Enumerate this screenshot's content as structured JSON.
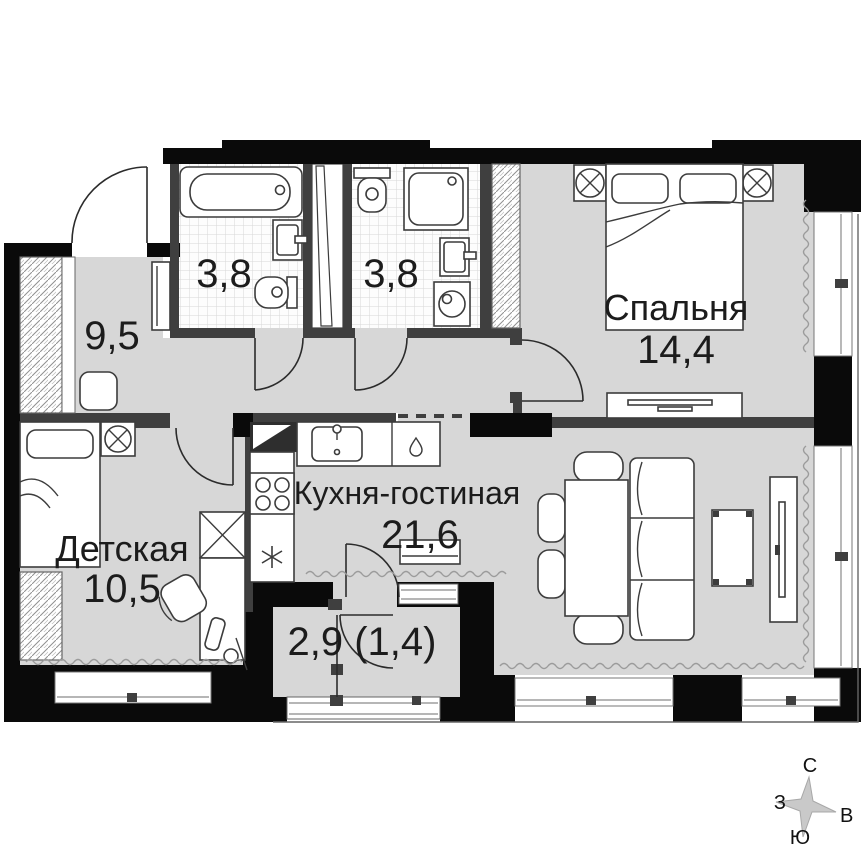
{
  "plan": {
    "title": "apartment-floor-plan",
    "rooms": [
      {
        "id": "hallway",
        "name": "",
        "area": "9,5"
      },
      {
        "id": "bathroom-1",
        "name": "",
        "area": "3,8"
      },
      {
        "id": "bathroom-2",
        "name": "",
        "area": "3,8"
      },
      {
        "id": "bedroom",
        "name": "Спальня",
        "area": "14,4"
      },
      {
        "id": "kitchen-living",
        "name": "Кухня-гостиная",
        "area": "21,6"
      },
      {
        "id": "children-room",
        "name": "Детская",
        "area": "10,5"
      },
      {
        "id": "balcony",
        "name": "",
        "area": "2,9 (1,4)"
      }
    ],
    "compass": {
      "north": "С",
      "south": "Ю",
      "west": "З",
      "east": "В"
    },
    "colors": {
      "floor": "#d7d7d7",
      "outer_wall": "#0a0a0a",
      "partition": "#3f3f3f",
      "wave": "#9b9b9b",
      "tile_line": "#d8d8d8"
    }
  }
}
